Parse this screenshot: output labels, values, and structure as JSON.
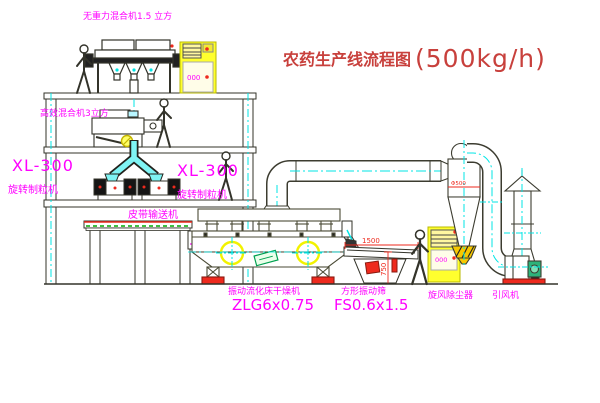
{
  "title": {
    "name_cn": "农药生产线流程图",
    "capacity": "(500kg/h)"
  },
  "labels": {
    "gravity_mixer": "无重力混合机1.5 立方",
    "high_eff_mixer": "高效混合机3立方",
    "granulator_left_model": "XL-300",
    "granulator_left_name": "旋转制粒机",
    "granulator_right_model": "XL-300",
    "granulator_right_name": "旋转制粒机",
    "belt_conveyor": "皮带输送机",
    "dryer_name": "振动流化床干燥机",
    "dryer_model": "ZLG6x0.75",
    "screen_name": "方形振动筛",
    "screen_model": "FS0.6x1.5",
    "cyclone_name": "旋风除尘器",
    "fan_name": "引风机"
  },
  "dimensions": {
    "screen_length": "1500",
    "screen_height": "750",
    "cyclone_dia": "Φ500"
  },
  "cabinet_display": {
    "top": "000",
    "right": "000"
  },
  "colors": {
    "label_magenta": "#ff00ff",
    "title_red": "#c8403c",
    "line_dark": "#33332a",
    "centerline_cyan": "#00e5e5",
    "equipment_yellow": "#ffff2e",
    "accent_red": "#ee2a1e",
    "motor_green": "#2db37a",
    "belt_green": "#00aa00"
  }
}
